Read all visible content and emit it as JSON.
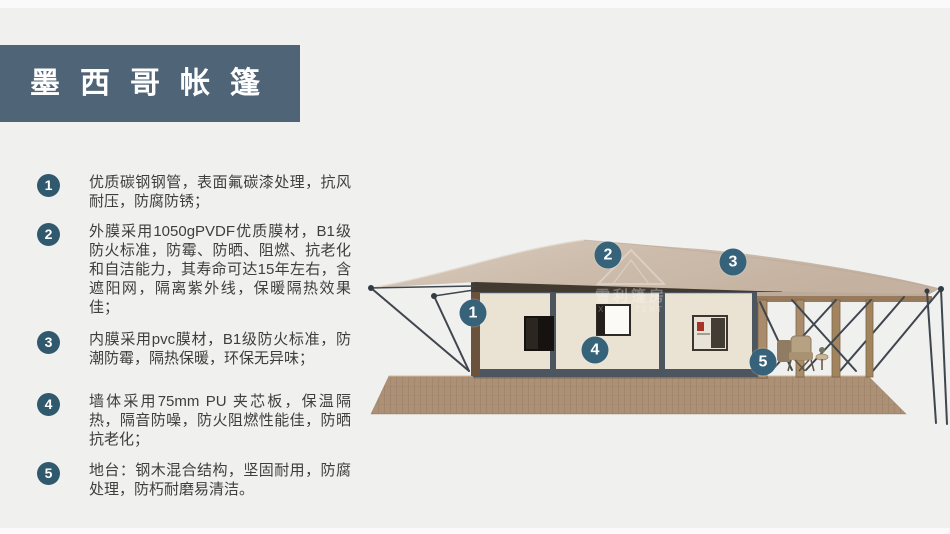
{
  "header": {
    "title": "墨西哥帐篷"
  },
  "features": {
    "items": [
      {
        "num": "1",
        "text": "优质碳钢钢管，表面氟碳漆处理，抗风耐压，防腐防锈；"
      },
      {
        "num": "2",
        "text": "外膜采用1050gPVDF优质膜材，B1级防火标准，防霉、防晒、阻燃、抗老化和自洁能力，其寿命可达15年左右，含遮阳网，隔离紫外线，保暖隔热效果佳；"
      },
      {
        "num": "3",
        "text": "内膜采用pvc膜材，B1级防火标准，防潮防霉，隔热保暖，环保无异味；"
      },
      {
        "num": "4",
        "text": "墙体采用75mm PU 夹芯板，保温隔热，隔音防噪，防火阻燃性能佳，防晒抗老化；"
      },
      {
        "num": "5",
        "text": "地台：钢木混合结构，坚固耐用，防腐处理，防朽耐磨易清洁。"
      }
    ]
  },
  "diagram": {
    "markers": [
      {
        "num": "1"
      },
      {
        "num": "2"
      },
      {
        "num": "3"
      },
      {
        "num": "4"
      },
      {
        "num": "5"
      }
    ],
    "watermark": {
      "cn": "雪利篷房",
      "en": "XUELI TENT"
    }
  },
  "colors": {
    "background": "#f0f0ef",
    "title_box": "#4f6477",
    "list_badge": "#30596d",
    "image_marker": "#36627a",
    "roof": "#ccbaaa",
    "wall": "#eae2d2",
    "deck": "#ad9176"
  }
}
